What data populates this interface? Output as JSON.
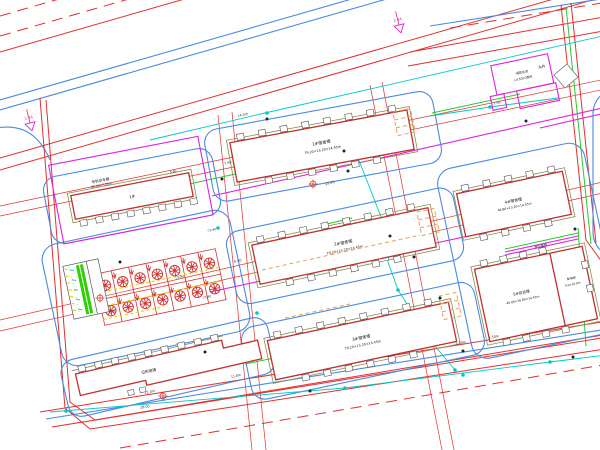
{
  "canvas": {
    "background": "#ffffff",
    "width": 600,
    "height": 450
  },
  "colors": {
    "boundary_red": "#e03030",
    "road_blue": "#4a8ae0",
    "utility_cyan": "#00c8c8",
    "property_magenta": "#e020e0",
    "landscape_green": "#28c828",
    "building_red": "#c03030",
    "outline_olive": "#8a8a50",
    "stair_orange": "#e8a060",
    "stall_yellow": "#e8d800",
    "tree_red": "#d03030"
  },
  "buildings": {
    "b1": {
      "name": "1#宿舍楼",
      "dims": "79.20×13.20×14.45m"
    },
    "b2": {
      "name": "2#宿舍楼",
      "dims": "79.20×13.20×14.45m"
    },
    "b3": {
      "name": "3#宿舍楼",
      "dims": "79.20×13.20×14.45m"
    },
    "b4": {
      "name": "4#宿舍楼",
      "dims": "46.80×13.20×14.45m"
    },
    "b5": {
      "name": "5#综合楼",
      "dims": "46.80×16.80×14.45m"
    },
    "b5_annex": {
      "name": "配电房",
      "dims": "9.0×16.8m"
    },
    "bike_shed": {
      "name": "非机动车棚",
      "dims": "80.00×7.20m",
      "mark": "1#",
      "elev": "5.90"
    },
    "shops": {
      "name": "沿街商铺",
      "dim": "11.0m"
    },
    "pump": {
      "name": "消防水池",
      "dims": "(-4.50m)泵房"
    },
    "well": {
      "label": "水井"
    }
  },
  "markers": {
    "entrance": "2.44",
    "elev": "▽5.90"
  },
  "dims": {
    "d1": "15.00",
    "d2": "7.50",
    "d3": "6.00",
    "d4": "11.0m",
    "d5": "1.50m",
    "d6": "3.50m",
    "d7": "18.00",
    "d8": "14.5m",
    "d9": "7.50"
  },
  "notes": {
    "gas": "燃气管线"
  },
  "parking": {
    "tree_count": 14,
    "rows": 2,
    "cols": 7
  }
}
